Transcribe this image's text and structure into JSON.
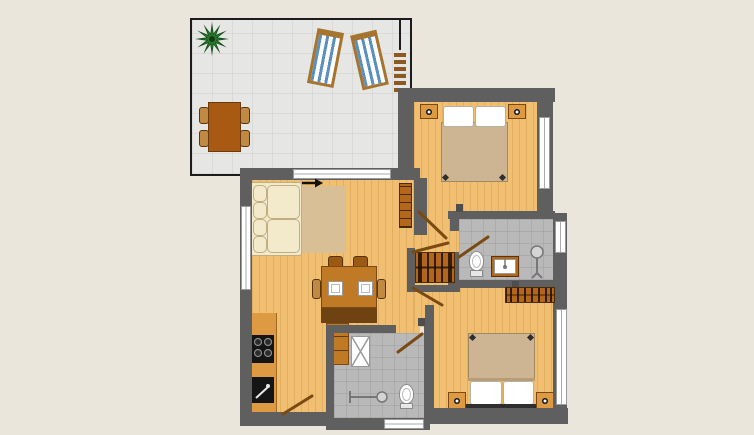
{
  "title": "Apartment floor plan with terrace",
  "colors": {
    "background": "#eae6dc",
    "wall": "#5f5f5f",
    "wood_floor": "#f0bf72",
    "tile_floor": "#e6e6e4",
    "bath_floor": "#b9b9b9",
    "furniture_brown": "#b3671c",
    "furniture_dark": "#6f4212",
    "table_brown": "#c07a26",
    "terrace_table_brown": "#a85a12",
    "sofa_cream": "#f3e9cb",
    "rug_tan": "#d9bf95",
    "blanket_tan": "#cdb492",
    "lounger_blue": "#5b8fc0",
    "lounger_frame": "#a5742e",
    "counter_orange": "#dd9a42",
    "plant_green": "#1d5c21",
    "door_line": "#7a4a12",
    "appliance_black": "#151515",
    "white": "#ffffff"
  },
  "rooms": [
    {
      "name": "terrace",
      "floor": "gray tiles",
      "furniture": [
        "potted plant",
        "sun lounger",
        "sun lounger",
        "ladder",
        "dining table",
        "4 chairs"
      ]
    },
    {
      "name": "living room",
      "floor": "wood",
      "furniture": [
        "corner sofa",
        "rug",
        "dining table",
        "4 chairs",
        "2 plates",
        "sideboard",
        "cabinet",
        "bookshelf"
      ]
    },
    {
      "name": "kitchen",
      "floor": "wood",
      "furniture": [
        "kitchen counter",
        "cooktop with 4 burners",
        "sink"
      ]
    },
    {
      "name": "hallway",
      "floor": "wood",
      "furniture": [
        "wardrobe closet with hangers"
      ]
    },
    {
      "name": "bedroom 1",
      "floor": "wood",
      "furniture": [
        "double bed",
        "2 pillows",
        "2 nightstands with lamps"
      ]
    },
    {
      "name": "bedroom 2",
      "floor": "wood",
      "furniture": [
        "double bed",
        "2 pillows",
        "2 nightstands with lamps",
        "wardrobe with hangers"
      ]
    },
    {
      "name": "bathroom 1",
      "floor": "gray tiles",
      "furniture": [
        "toilet",
        "washbasin vanity",
        "shower fixture"
      ]
    },
    {
      "name": "bathroom 2",
      "floor": "gray tiles",
      "furniture": [
        "shower tray",
        "shower fixture",
        "toilet"
      ]
    }
  ],
  "annotations": [
    "entrance arrow",
    "door swing lines",
    "windows as white strips"
  ]
}
